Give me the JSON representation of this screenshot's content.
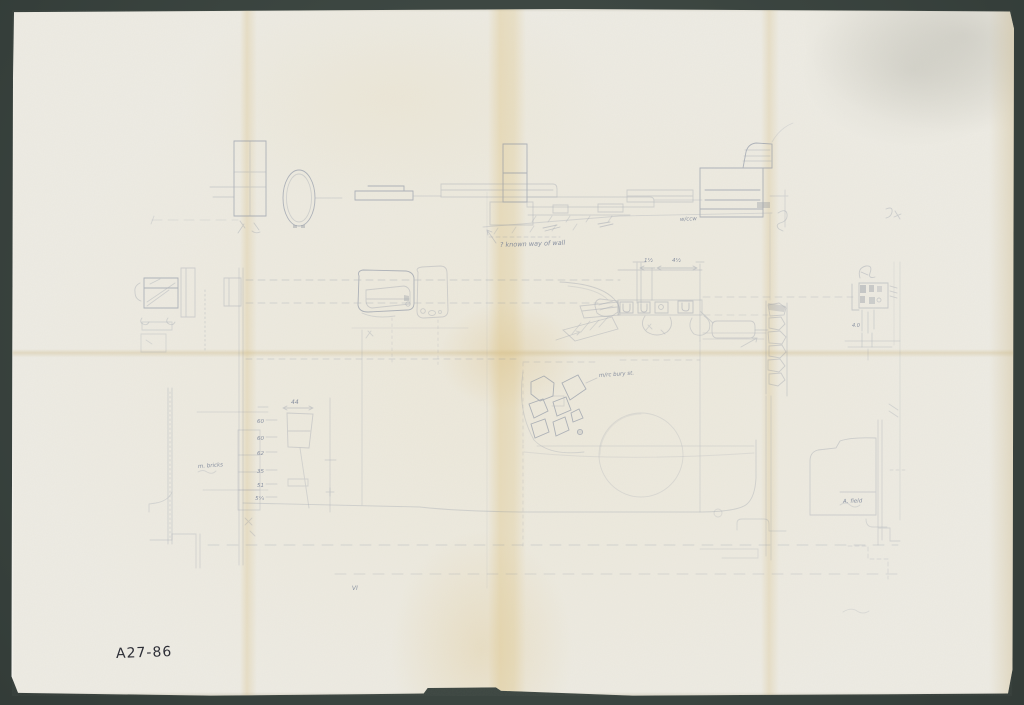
{
  "scene": {
    "background_color": "#3e4742",
    "paper_color": "#edebe3",
    "crease_color": "#dfc894",
    "pencil_color": "#7b859a",
    "ink_color": "#2e2f37"
  },
  "document": {
    "kind": "scanned hand-drawn excavation plan, folded sheet",
    "archive_label": "A27-86"
  },
  "annotations": {
    "top_note": "? known way of wall",
    "elevation_mark": "w/ccw",
    "stones_note": "m/rc bury st.",
    "bricks_note": "m. bricks",
    "field_note": "A. field",
    "bottom_mark": "VI",
    "right_mark": "4.0"
  },
  "measurements": {
    "top_width": "44",
    "column": [
      "60",
      "60",
      "62",
      "35",
      "51",
      "5¼"
    ],
    "center_dims": [
      "1½",
      "4½"
    ]
  }
}
